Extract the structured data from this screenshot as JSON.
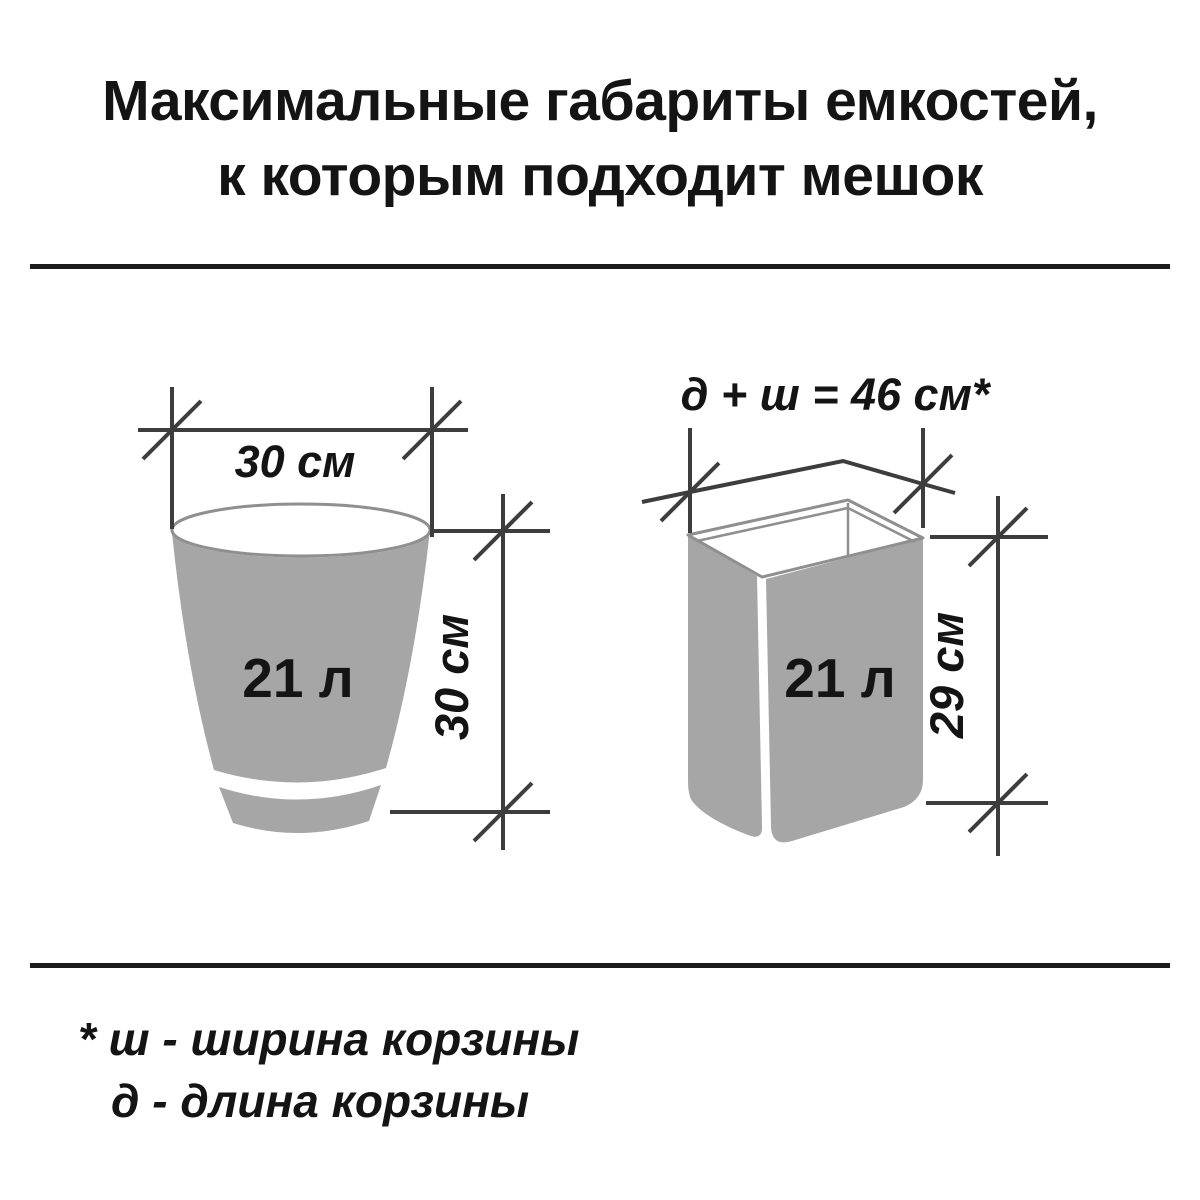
{
  "title": {
    "line1": "Максимальные габариты емкостей,",
    "line2": "к которым подходит мешок"
  },
  "left_diagram": {
    "volume_label": "21 л",
    "width_dimension": "30 см",
    "height_dimension": "30 см"
  },
  "right_diagram": {
    "volume_label": "21 л",
    "top_dimension": "д + ш = 46 см*",
    "height_dimension": "29 см"
  },
  "footnote": {
    "line1": "* ш - ширина корзины",
    "line2": "д - длина корзины"
  },
  "colors": {
    "background": "#ffffff",
    "container_fill": "#a6a6a6",
    "container_outline": "#8f8f8f",
    "dimension_line": "#3d3d3d",
    "text": "#141414"
  }
}
